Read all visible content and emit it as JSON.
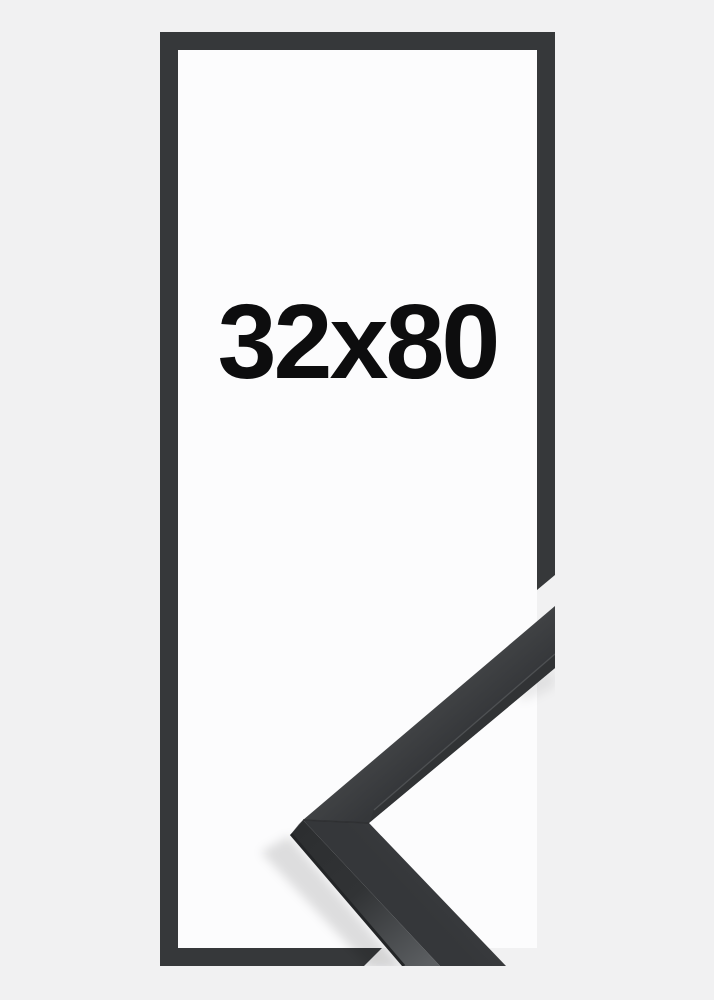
{
  "product": {
    "size_label": "32x80",
    "description": "Black picture frame, size 32x80, with corner sample detail"
  },
  "colors": {
    "background": "#f1f1f2",
    "inner_area": "#fcfcfd",
    "frame_outline": "#36383a",
    "moulding_face_light": "#434547",
    "moulding_face": "#3b3d3f",
    "moulding_face_dark": "#35373a",
    "inner_lip": "#313335",
    "lip_highlight": "#55575a",
    "side_facet_dark": "#2c2e30",
    "side_facet_light": "#5e6164",
    "under_edge": "#232527",
    "miter_seam": "#2b2d2f",
    "label_text": "#0d0d0e",
    "shadow": "#000000"
  }
}
